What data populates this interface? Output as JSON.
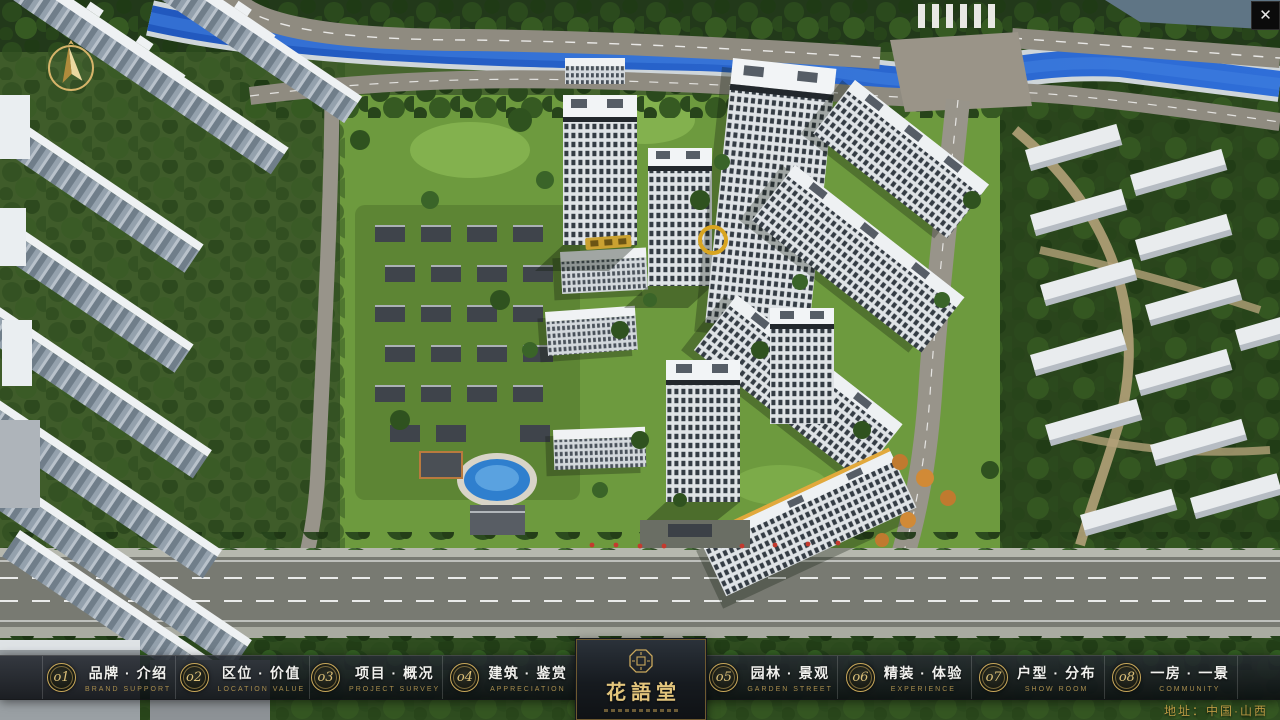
{
  "window": {
    "close_icon": "✕"
  },
  "brand": {
    "name": "花語堂"
  },
  "nav": {
    "items": [
      {
        "num": "o1",
        "zh": "品牌 · 介绍",
        "en": "BRAND SUPPORT"
      },
      {
        "num": "o2",
        "zh": "区位 · 价值",
        "en": "LOCATION VALUE"
      },
      {
        "num": "o3",
        "zh": "项目 · 概况",
        "en": "PROJECT SURVEY"
      },
      {
        "num": "o4",
        "zh": "建筑 · 鉴赏",
        "en": "APPRECIATION"
      },
      {
        "num": "o5",
        "zh": "园林 · 景观",
        "en": "GARDEN STREET"
      },
      {
        "num": "o6",
        "zh": "精装 · 体验",
        "en": "EXPERIENCE"
      },
      {
        "num": "o7",
        "zh": "户型 · 分布",
        "en": "SHOW ROOM"
      },
      {
        "num": "o8",
        "zh": "一房 · 一景",
        "en": "COMMUNITY"
      }
    ]
  },
  "footer": {
    "address": "地址：中国·山西"
  },
  "colors": {
    "gold": "#c9a85a",
    "bar_bg": "rgba(15,19,24,0.85)",
    "river": "#2762cc"
  }
}
